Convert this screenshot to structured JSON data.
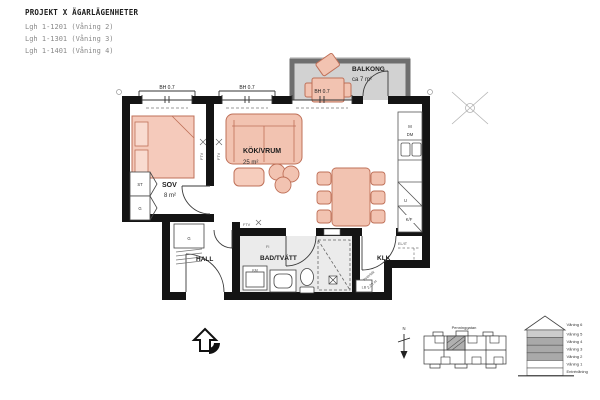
{
  "header": {
    "title": "PROJEKT X ÄGARLÄGENHETER",
    "units": [
      "Lgh 1-1201 (Våning 2)",
      "Lgh 1-1301 (Våning 3)",
      "Lgh 1-1401 (Våning 4)"
    ]
  },
  "rooms": {
    "sov": {
      "name": "SOV",
      "area": "8 m²"
    },
    "kokvrum": {
      "name": "KÖK/VRUM",
      "area": "25 m²"
    },
    "hall": {
      "name": "HALL"
    },
    "badtvatt": {
      "name": "BAD/TVÄTT"
    },
    "klk": {
      "name": "KLK"
    },
    "balkong": {
      "name": "BALKONG",
      "area": "ca 7 m²"
    }
  },
  "labels": {
    "window_height": "BH 0.7",
    "st": "ST",
    "g": "G",
    "m": "M",
    "dm": "DM",
    "u": "U",
    "kf": "K/F",
    "km": "KM",
    "fi": "FI",
    "elit": "EL/IT",
    "lb": "LB",
    "ftv": "FTV",
    "ceiling_note_1": "Innertak",
    "ceiling_note_2": "2,20 m",
    "north": "N"
  },
  "site_plan": {
    "street": "Penninggatan"
  },
  "section": {
    "floors": [
      "Våning 6",
      "Våning 5",
      "Våning 4",
      "Våning 3",
      "Våning 2",
      "Våning 1",
      "Entrévåning"
    ]
  },
  "colors": {
    "wall": "#141414",
    "furniture": "#f2c3b1",
    "furniture_stroke": "#bf7058",
    "balcony_floor": "#d2d2d2",
    "bath_floor": "#ebebeb",
    "highlight_floor": "#a9a9a9"
  }
}
